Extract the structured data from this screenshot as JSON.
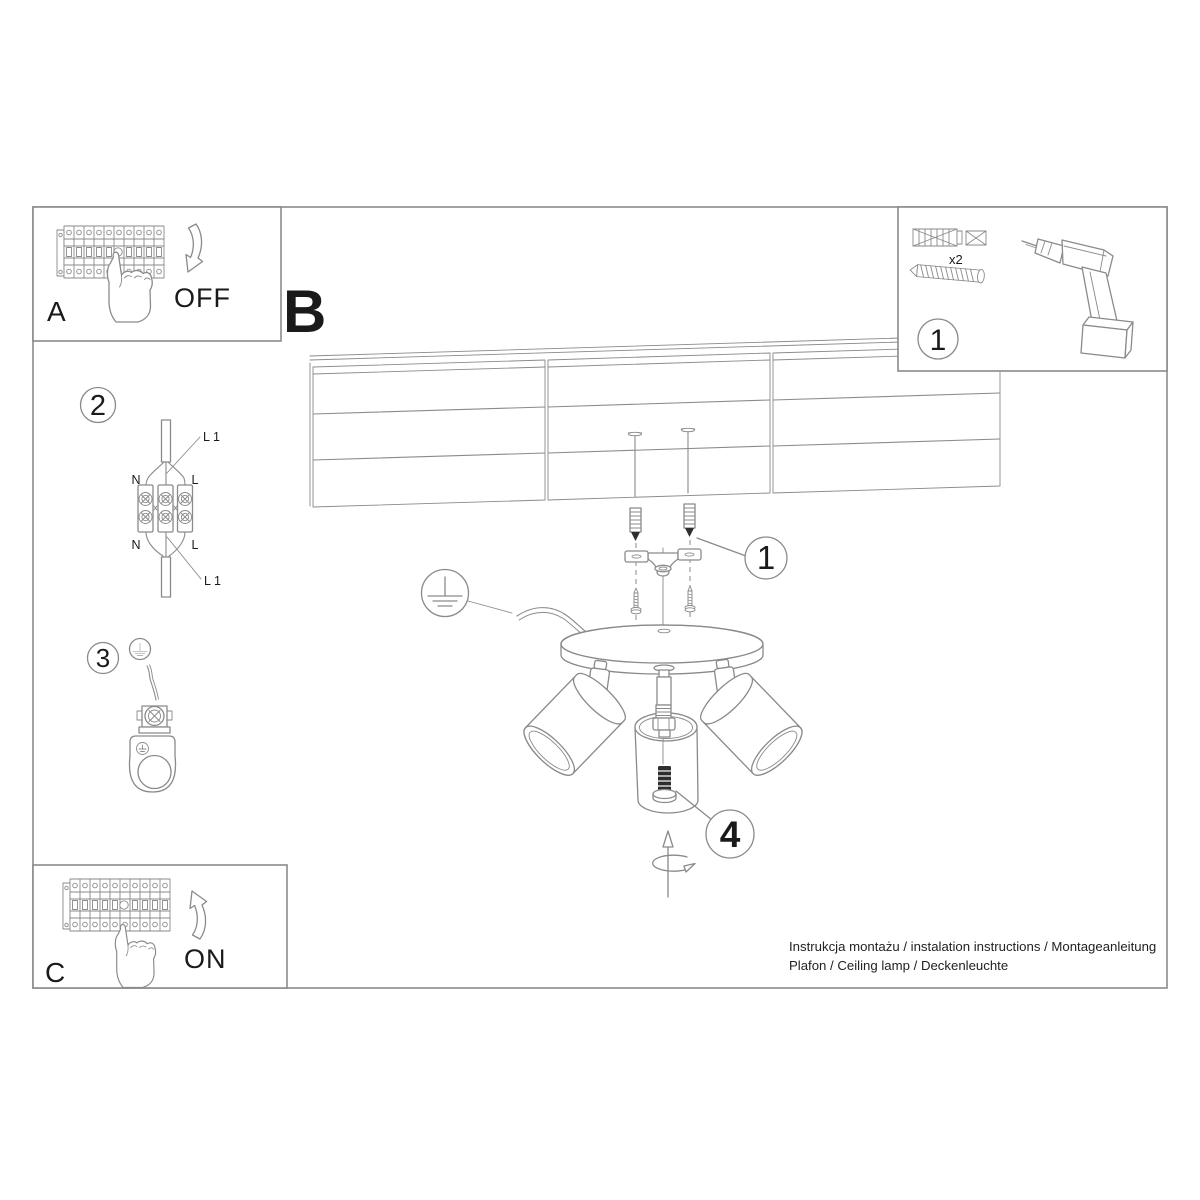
{
  "colors": {
    "line": "#8a8a8a",
    "dark": "#2e2e2e",
    "text": "#1a1a1a",
    "bg": "#ffffff"
  },
  "box_off": {
    "label": "A",
    "switch_state": "OFF"
  },
  "section": {
    "label": "B"
  },
  "parts_box": {
    "step_number": "1",
    "anchor_qty": "x2"
  },
  "wiring_step": {
    "step_number": "2",
    "labels": {
      "live_top": "L 1",
      "neutral_top": "N",
      "line_top": "L",
      "neutral_bottom": "N",
      "line_bottom": "L",
      "live_bottom": "L 1"
    }
  },
  "ground_step": {
    "step_number": "3"
  },
  "mounting": {
    "anchor_callout": "1",
    "bulb_callout": "4"
  },
  "box_on": {
    "label": "C",
    "switch_state": "ON"
  },
  "footer": {
    "line1": "Instrukcja montażu / instalation instructions / Montageanleitung",
    "line2": "Plafon / Ceiling lamp / Deckenleuchte"
  }
}
